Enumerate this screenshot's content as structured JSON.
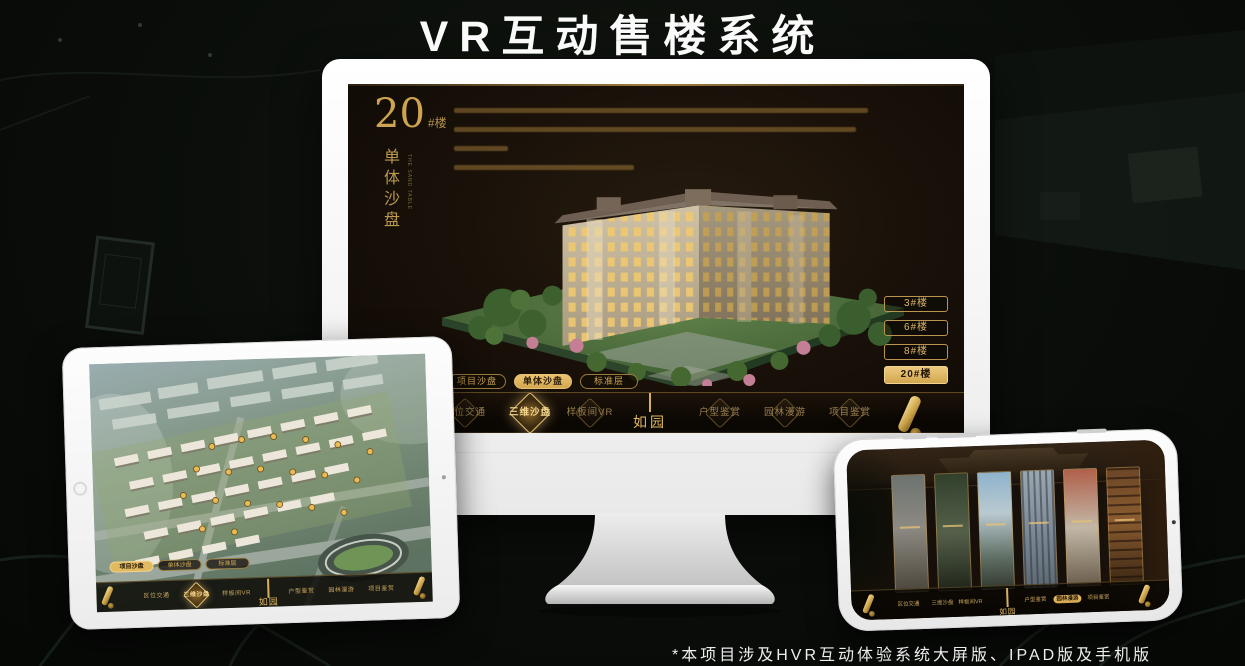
{
  "title": "VR互动售楼系统",
  "footnote": "*本项目涉及HVR互动体验系统大屏版、IPAD版及手机版",
  "colors": {
    "gold": "#d9b05e",
    "gold_dim": "#b3924a",
    "screen_bg": "#17100a",
    "background": "#0a0d0a"
  },
  "monitor": {
    "headline": {
      "number": "20",
      "suffix": "#楼",
      "subtitle": "单体沙盘",
      "subtitle_en": "THE SAND TABLE"
    },
    "floor_buttons": [
      {
        "label": "3#楼",
        "active": false
      },
      {
        "label": "6#楼",
        "active": false
      },
      {
        "label": "8#楼",
        "active": false
      },
      {
        "label": "20#楼",
        "active": true
      }
    ],
    "sub_tabs": [
      {
        "label": "项目沙盘",
        "active": false
      },
      {
        "label": "单体沙盘",
        "active": true
      },
      {
        "label": "标准层",
        "active": false
      }
    ],
    "nav_items": [
      {
        "label": "区位交通",
        "active": false
      },
      {
        "label": "三维沙盘",
        "active": true
      },
      {
        "label": "样板间VR",
        "active": false
      },
      {
        "label": "户型鉴赏",
        "active": false
      },
      {
        "label": "园林漫游",
        "active": false
      },
      {
        "label": "项目鉴赏",
        "active": false
      }
    ],
    "logo": "如园"
  },
  "ipad": {
    "sub_tabs": [
      {
        "label": "项目沙盘",
        "active": true
      },
      {
        "label": "单体沙盘",
        "active": false
      },
      {
        "label": "标准层",
        "active": false
      }
    ],
    "nav_items": [
      {
        "label": "区位交通",
        "active": false
      },
      {
        "label": "三维沙盘",
        "active": true
      },
      {
        "label": "样板间VR",
        "active": false
      },
      {
        "label": "户型鉴赏",
        "active": false
      },
      {
        "label": "园林漫游",
        "active": false
      },
      {
        "label": "项目鉴赏",
        "active": false
      }
    ],
    "logo": "如园"
  },
  "phone": {
    "nav_items": [
      {
        "label": "区位交通",
        "active": false
      },
      {
        "label": "三维沙盘",
        "active": false
      },
      {
        "label": "样板间VR",
        "active": false
      },
      {
        "label": "户型鉴赏",
        "active": false
      },
      {
        "label": "园林漫游",
        "active": true
      },
      {
        "label": "项目鉴赏",
        "active": false
      }
    ],
    "logo": "如园"
  }
}
